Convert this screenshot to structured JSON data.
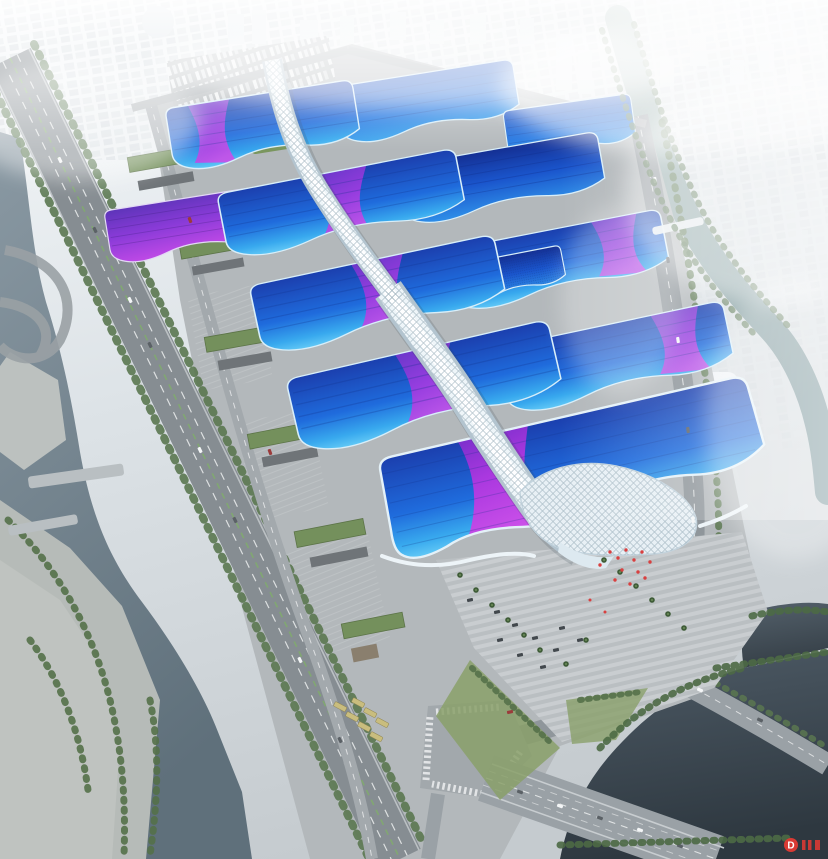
{
  "title": "Aerial rendering of a riverside exhibition and convention center complex",
  "watermark": {
    "logo_letter": "D",
    "color": "#d93a34"
  },
  "colors": {
    "haze_top": "#f4f7f9",
    "haze_mid": "#dde3e7",
    "haze_low": "#c5cbcf",
    "city_block": "#e3e9ed",
    "water_river": "#8a99a3",
    "water_river_deep": "#5f707b",
    "water_pond": "#4e5b66",
    "water_pond_deep": "#2e3840",
    "water_canal": "#a3b8b4",
    "water_canal_deep": "#6e8c92",
    "road": "#8a9196",
    "road_light": "#9ba1a6",
    "lane_line": "#eceeef",
    "apron": "#b3b8bb",
    "roof_deep": "#1b3fae",
    "roof_blue": "#1f6bdc",
    "roof_cyan": "#62c9f6",
    "ribbon_purple": "#6f37cc",
    "ribbon_magenta": "#c94fe8",
    "grand_ribbon_from": "#7c2ecc",
    "grand_ribbon_to": "#d14ae8",
    "spine_white": "#eef5f9",
    "spine_shade": "#b3c4cf",
    "tree_green": "#55714a",
    "lawn_green": "#7a965e",
    "plaza_steps": "#c6cacc",
    "red_accent": "#d84040",
    "bus_yellow": "#c9bd7e"
  },
  "scene": {
    "view": "oblique bird's-eye aerial, hazy daylight",
    "complex": "rows of exhibition halls with wave-form roofs in cyan-to-deep-blue gradients crossed by purple ribbon bands",
    "central_spine": "white serpentine concourse running diagonally through the halls, ending in a quilted white shell over the grand south hall",
    "grand_hall": "largest southern hall with a giant magenta S-curve ribbon and white wavy fascia",
    "entrance_plaza": "stepped paved plaza with palm trees and red festival decorations",
    "waterways": "river with terraced park on the west, green canal on the east, dark pond at the southeast",
    "roads": "multi-lane expressway along the west side, avenue on the east, boulevard and bridge intersection at the south",
    "background": "city blocks and towers fading into white haze toward the horizon",
    "hall_roofs_visible": 12
  }
}
